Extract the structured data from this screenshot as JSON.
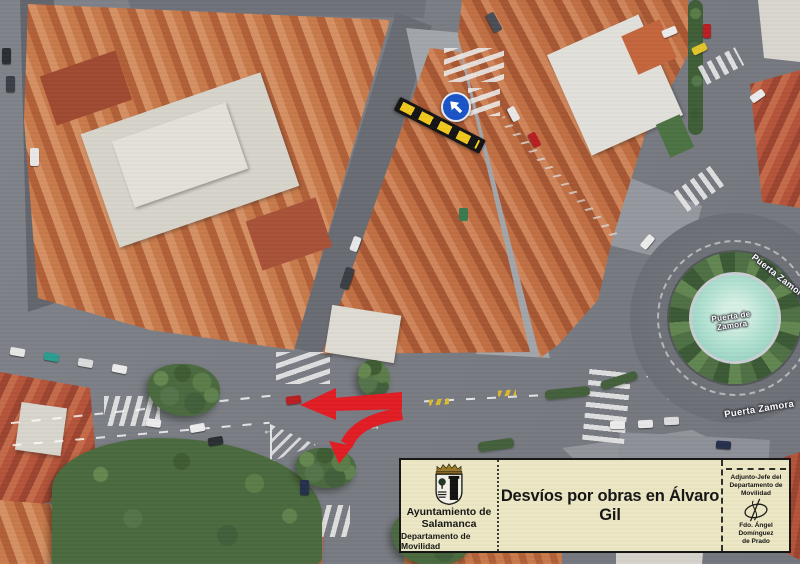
{
  "colors": {
    "box_bg": "#ece7c3",
    "box_border": "#141414",
    "detour_red": "#e21d24",
    "closure_yellow": "#f2c81e",
    "closure_black": "#141414",
    "sign_blue": "#1b54c8"
  },
  "info_box": {
    "org_line1": "Ayuntamiento de",
    "org_line2": "Salamanca",
    "org_line3": "Departamento de Movilidad",
    "title": "Desvíos por obras en Álvaro Gil",
    "signer_role_line1": "Adjunto-Jefe del",
    "signer_role_line2": "Departamento de",
    "signer_role_line3": "Movilidad",
    "signer_name_line1": "Fdo. Ángel Domínguez",
    "signer_name_line2": "de Prado"
  },
  "map_labels": {
    "roundabout_line1": "Puerta de",
    "roundabout_line2": "Zamora",
    "street_northeast": "Puerta Zamora",
    "street_south": "Puerta Zamora"
  }
}
